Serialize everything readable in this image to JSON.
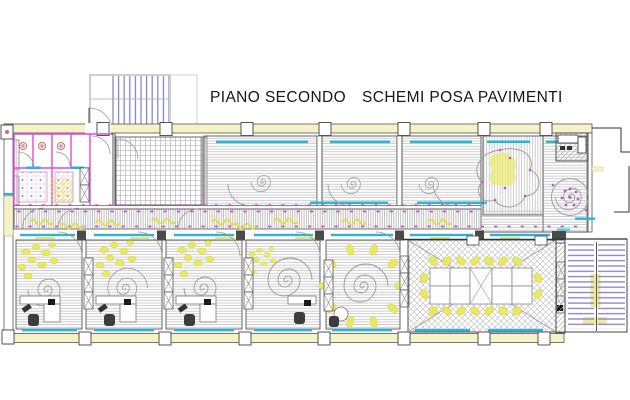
{
  "title": {
    "floor_label": "PIANO SECONDO",
    "scheme_label": "SCHEMI POSA PAVIMENTI"
  },
  "palette": {
    "wall_fill_yellow": "#f6f2c8",
    "decor_yellow": "#e9e95f",
    "window_cyan": "#2ab4d8",
    "stair_blue": "#7d7dc6",
    "partition_magenta": "#dd4add",
    "dot_magenta": "#c94fc4",
    "fixture_red": "#d66a6a",
    "hatch_gray": "#b5b5b5",
    "wall_dark": "#444444"
  }
}
